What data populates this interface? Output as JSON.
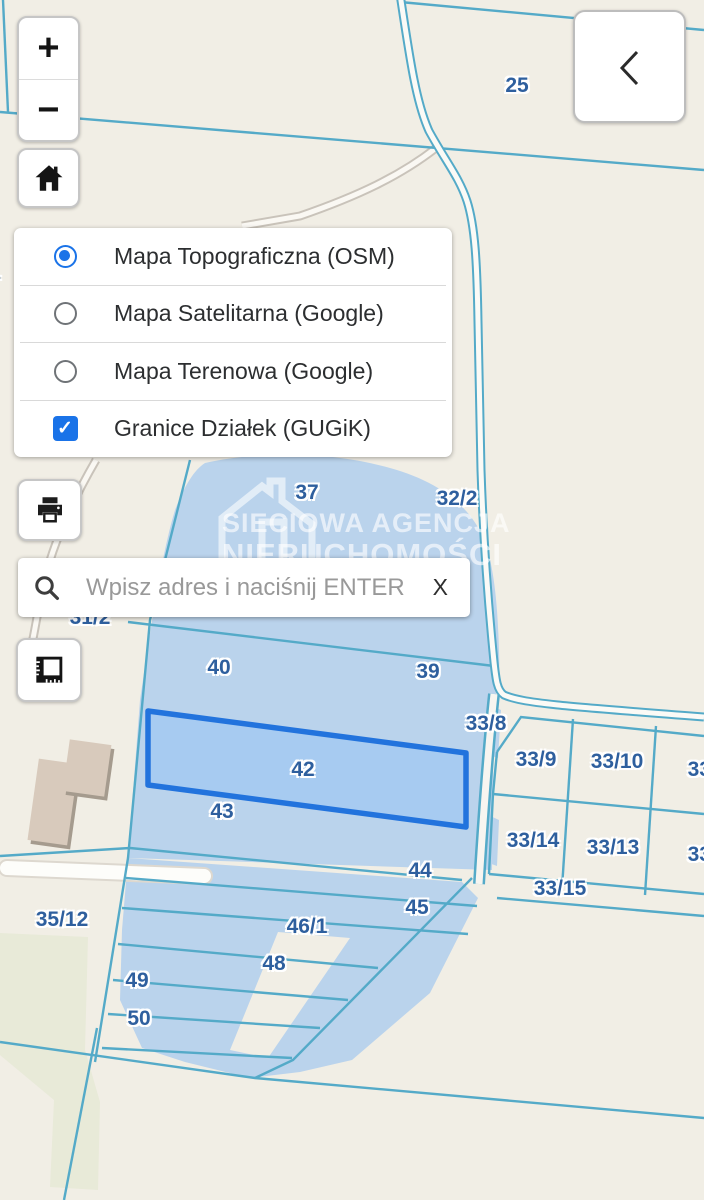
{
  "controls": {
    "zoom_in_label": "+",
    "zoom_out_label": "−",
    "home_icon": "home-icon",
    "back_icon": "chevron-left-icon",
    "print_icon": "printer-icon",
    "measure_icon": "ruler-square-icon"
  },
  "layer_panel": {
    "options": [
      {
        "label": "Mapa Topograficzna (OSM)",
        "selected": true
      },
      {
        "label": "Mapa Satelitarna (Google)",
        "selected": false
      },
      {
        "label": "Mapa Terenowa (Google)",
        "selected": false
      }
    ],
    "overlay_toggle": {
      "label": "Granice Działek (GUGiK)",
      "checked": true
    }
  },
  "search": {
    "placeholder": "Wpisz adres i naciśnij ENTER",
    "value": "",
    "clear_label": "X"
  },
  "watermark": {
    "line1": "SIECIOWA AGENCJA",
    "line2": "NIERUCHOMOŚCI",
    "line3": "SIECIOWA"
  },
  "map": {
    "selected_parcel": "42",
    "parcels": [
      {
        "label": "25"
      },
      {
        "label": "/1"
      },
      {
        "label": "37"
      },
      {
        "label": "32/2"
      },
      {
        "label": "31/2"
      },
      {
        "label": "40"
      },
      {
        "label": "39"
      },
      {
        "label": "33/8"
      },
      {
        "label": "33/9"
      },
      {
        "label": "33/10"
      },
      {
        "label": "33/1"
      },
      {
        "label": "42"
      },
      {
        "label": "43"
      },
      {
        "label": "33/14"
      },
      {
        "label": "33/13"
      },
      {
        "label": "33/1"
      },
      {
        "label": "44"
      },
      {
        "label": "33/15"
      },
      {
        "label": "45"
      },
      {
        "label": "35/12"
      },
      {
        "label": "46/1"
      },
      {
        "label": "48"
      },
      {
        "label": "49"
      },
      {
        "label": "50"
      }
    ]
  },
  "colors": {
    "background": "#f1eee5",
    "boundary_line": "#54aac8",
    "area_fill": "#bad3ec",
    "highlight_stroke": "#2273dd",
    "highlight_fill": "#a7cbf1",
    "parcel_label": "#2e5f9e",
    "accent": "#1a73e8"
  }
}
